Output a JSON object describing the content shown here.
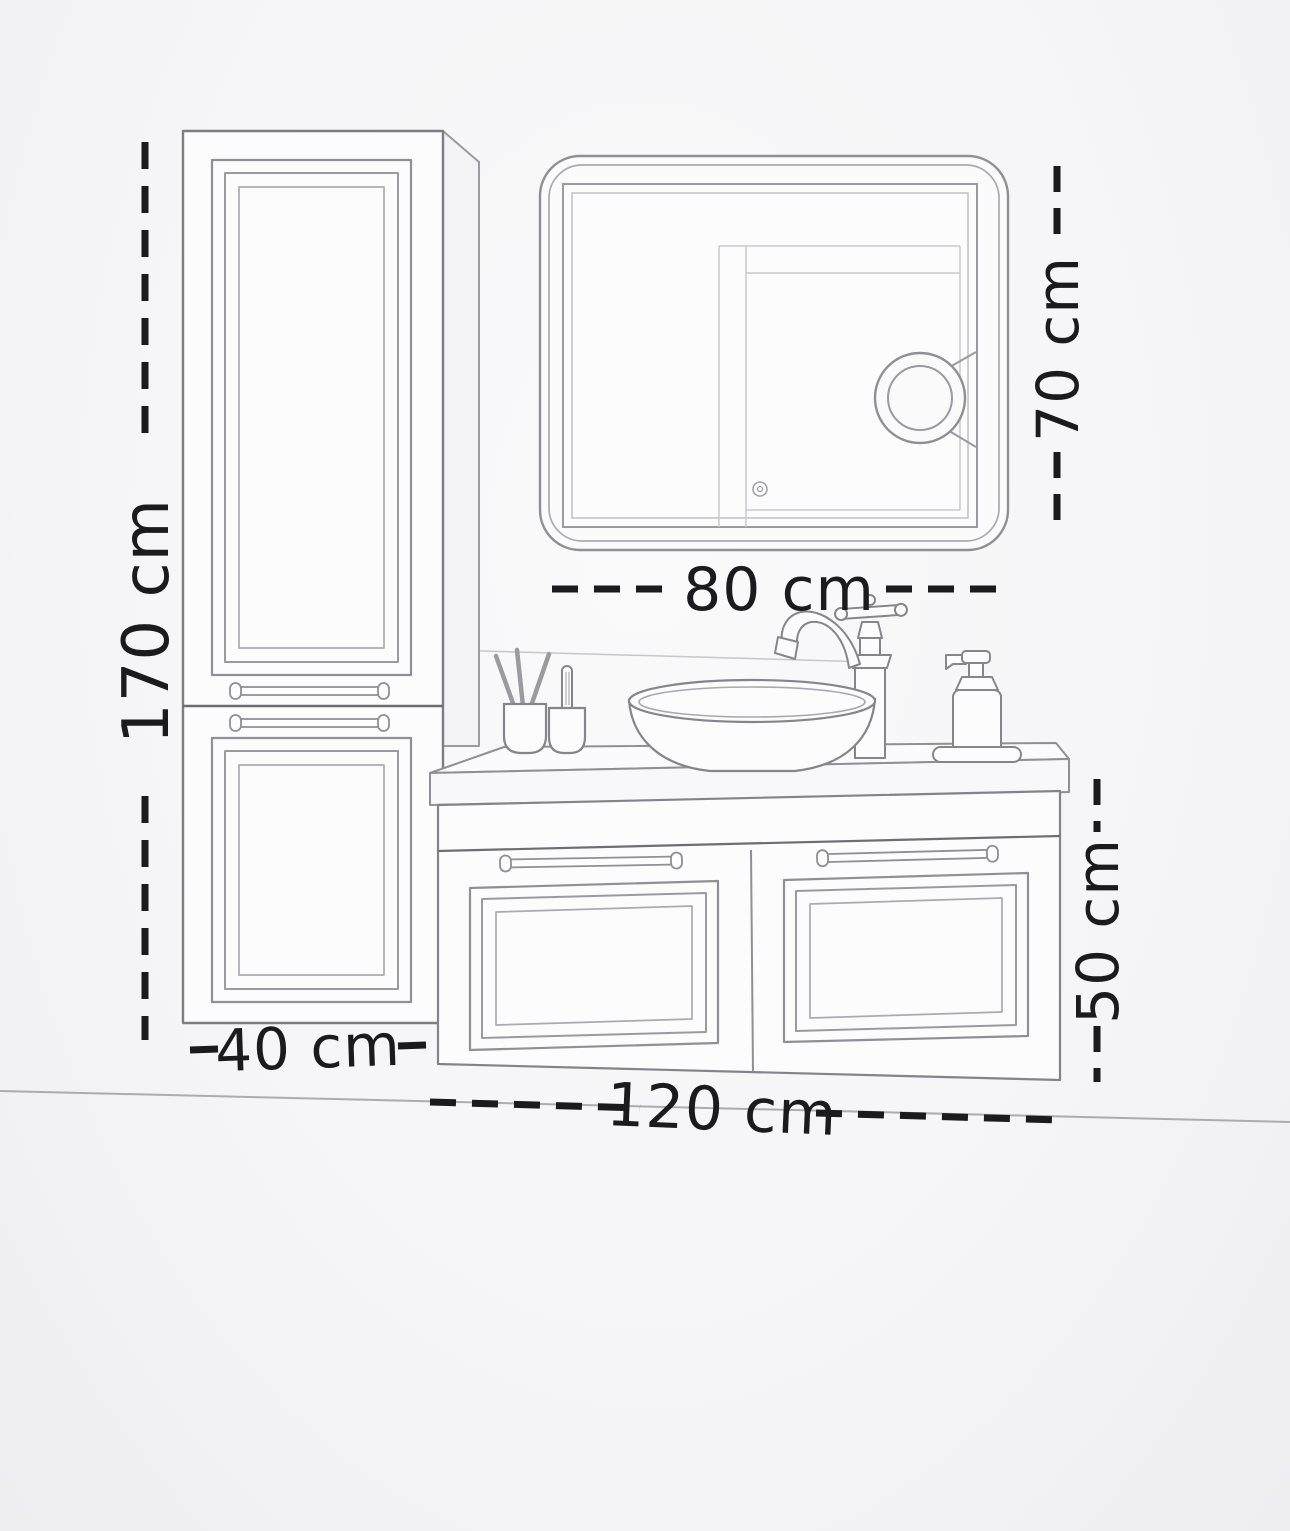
{
  "diagram": {
    "type": "technical-drawing",
    "subject": "bathroom vanity furniture set with dimensions",
    "labels": {
      "tall_cabinet_height": "170 cm",
      "tall_cabinet_width": "40 cm",
      "mirror_width": "80 cm",
      "mirror_height": "70 cm",
      "vanity_height": "50 cm",
      "vanity_width": "120 cm"
    },
    "components": {
      "tall_cabinet": "tall side cabinet with two framed doors",
      "mirror": "rounded rectangle LED mirror with magnifying mirror and touch button",
      "vanity": "wall-hung vanity with countertop, two framed doors and bar handles",
      "sink": "oval vessel sink",
      "faucet": "vintage single-lever faucet",
      "accessories": "brush cups, soap dispenser on tray"
    },
    "colors": {
      "background": "#f5f5f7",
      "outline": "#8f8f95",
      "outline_light": "#c3c3c9",
      "outline_dark": "#66666c",
      "dimension": "#1b1b1e"
    }
  }
}
